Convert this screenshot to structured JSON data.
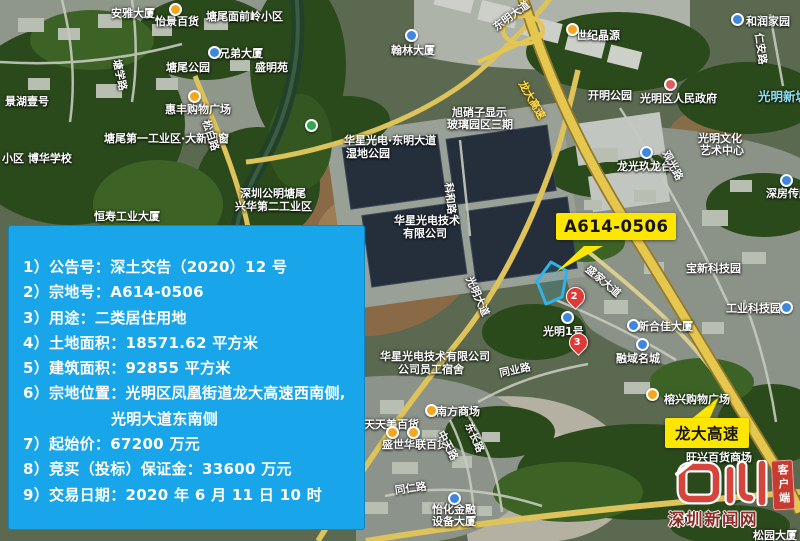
{
  "colors": {
    "panel_blue": "#18a5e9",
    "callout_yellow": "#ffe600",
    "parcel_outline": "#2fb3ea",
    "watermark_red": "#c63c30"
  },
  "info_panel": {
    "lines": [
      "1）公告号：深土交告（2020）12 号",
      "2）宗地号：A614-0506",
      "3）用途：二类居住用地",
      "4）土地面积：18571.62 平方米",
      "5）建筑面积：92855 平方米",
      "6）宗地位置：光明区凤凰街道龙大高速西南侧,",
      "光明大道东南侧",
      "7）起始价：67200 万元",
      "8）竞买（投标）保证金：33600 万元",
      "9）交易日期：2020 年 6 月 11 日 10 时"
    ]
  },
  "callouts": {
    "parcel": {
      "label": "A614-0506"
    },
    "highway": {
      "label": "龙大高速"
    }
  },
  "markers": [
    {
      "label": "2"
    },
    {
      "label": "3"
    }
  ],
  "watermark": {
    "site_name": "深圳新闻网",
    "badge": "客户端"
  },
  "map": {
    "labels": [
      {
        "text": "安雅大厦",
        "x": 111,
        "y": 5
      },
      {
        "text": "怡景百货",
        "x": 155,
        "y": 13
      },
      {
        "text": "塘尾面前岭小区",
        "x": 206,
        "y": 8
      },
      {
        "text": "兄弟大厦",
        "x": 219,
        "y": 45
      },
      {
        "text": "盛明苑",
        "x": 255,
        "y": 59
      },
      {
        "text": "塘尾公园",
        "x": 166,
        "y": 59
      },
      {
        "text": "景湖壹号",
        "x": 5,
        "y": 93
      },
      {
        "text": "惠丰购物广场",
        "x": 165,
        "y": 101
      },
      {
        "text": "翰林大厦",
        "x": 391,
        "y": 42
      },
      {
        "text": "世纪晶源",
        "x": 576,
        "y": 27
      },
      {
        "text": "和润家园",
        "x": 746,
        "y": 13
      },
      {
        "text": "开明公园",
        "x": 588,
        "y": 87
      },
      {
        "text": "光明区人民政府",
        "x": 640,
        "y": 90
      },
      {
        "text": "旭硝子显示",
        "x": 452,
        "y": 104
      },
      {
        "text": "玻璃园区三期",
        "x": 447,
        "y": 116
      },
      {
        "text": "塘尾第一工业区·大新门窗",
        "x": 104,
        "y": 130
      },
      {
        "text": "小区 博华学校",
        "x": 2,
        "y": 150
      },
      {
        "text": "恒寿工业大厦",
        "x": 94,
        "y": 208
      },
      {
        "text": "深圳公明塘尾",
        "x": 240,
        "y": 185
      },
      {
        "text": "兴华第二工业区",
        "x": 235,
        "y": 198
      },
      {
        "text": "华星光电·东明大道",
        "x": 344,
        "y": 132
      },
      {
        "text": "湿地公园",
        "x": 346,
        "y": 145
      },
      {
        "text": "华星光电技术",
        "x": 394,
        "y": 212
      },
      {
        "text": "有限公司",
        "x": 403,
        "y": 225
      },
      {
        "text": "光明文化",
        "x": 698,
        "y": 130
      },
      {
        "text": "艺术中心",
        "x": 700,
        "y": 142
      },
      {
        "text": "龙光玖龙台",
        "x": 617,
        "y": 158
      },
      {
        "text": "深房传麒山",
        "x": 766,
        "y": 185
      },
      {
        "text": "宝新科技园",
        "x": 686,
        "y": 260
      },
      {
        "text": "工业科技园",
        "x": 726,
        "y": 300
      },
      {
        "text": "新合佳大厦",
        "x": 638,
        "y": 318
      },
      {
        "text": "融域名城",
        "x": 616,
        "y": 350
      },
      {
        "text": "光明1号",
        "x": 543,
        "y": 323
      },
      {
        "text": "华星光电技术有限公司",
        "x": 380,
        "y": 348
      },
      {
        "text": "公司员工宿舍",
        "x": 398,
        "y": 361
      },
      {
        "text": "天天美百货",
        "x": 364,
        "y": 416
      },
      {
        "text": "南方商场",
        "x": 436,
        "y": 403
      },
      {
        "text": "盛世华联百货",
        "x": 382,
        "y": 436
      },
      {
        "text": "怡化金融",
        "x": 432,
        "y": 501
      },
      {
        "text": "设备大厦",
        "x": 432,
        "y": 513
      },
      {
        "text": "榕兴购物广场",
        "x": 664,
        "y": 391
      },
      {
        "text": "旺兴百货商场",
        "x": 686,
        "y": 449
      },
      {
        "text": "松园大厦",
        "x": 753,
        "y": 527
      },
      {
        "text": "光明新城",
        "x": 758,
        "y": 86,
        "cls": "mc"
      },
      {
        "text": "东明大道",
        "x": 490,
        "y": 22,
        "rot": -36,
        "cls": "mr"
      },
      {
        "text": "松白路",
        "x": 213,
        "y": 118,
        "rot": 72,
        "cls": "mr"
      },
      {
        "text": "塘学路",
        "x": 124,
        "y": 58,
        "rot": 78,
        "cls": "mr"
      },
      {
        "text": "科和路",
        "x": 456,
        "y": 182,
        "rot": 84,
        "cls": "mr"
      },
      {
        "text": "观光路",
        "x": 672,
        "y": 148,
        "rot": 62,
        "cls": "mr"
      },
      {
        "text": "盛家大道",
        "x": 592,
        "y": 262,
        "rot": 40,
        "cls": "mr"
      },
      {
        "text": "光明大道",
        "x": 476,
        "y": 274,
        "rot": 66,
        "cls": "mr"
      },
      {
        "text": "东长路",
        "x": 475,
        "y": 420,
        "rot": 66,
        "cls": "mr"
      },
      {
        "text": "中天路",
        "x": 447,
        "y": 428,
        "rot": 62,
        "cls": "mr"
      },
      {
        "text": "同业路",
        "x": 498,
        "y": 366,
        "rot": -12,
        "cls": "mr"
      },
      {
        "text": "同仁路",
        "x": 394,
        "y": 483,
        "rot": -8,
        "cls": "mr"
      },
      {
        "text": "仁安路",
        "x": 766,
        "y": 32,
        "rot": 82,
        "cls": "mr"
      },
      {
        "text": "光侨路",
        "x": 668,
        "y": 514,
        "rot": -10,
        "cls": "mr"
      },
      {
        "text": "龙大高速",
        "x": 528,
        "y": 78,
        "rot": 60,
        "cls": "mr mh"
      }
    ],
    "pois": [
      {
        "type": "shop",
        "x": 169,
        "y": 3
      },
      {
        "type": "shop",
        "x": 188,
        "y": 90
      },
      {
        "type": "shop",
        "x": 566,
        "y": 23
      },
      {
        "type": "shop",
        "x": 425,
        "y": 404
      },
      {
        "type": "shop",
        "x": 386,
        "y": 426
      },
      {
        "type": "shop",
        "x": 407,
        "y": 426
      },
      {
        "type": "shop",
        "x": 646,
        "y": 388
      },
      {
        "type": "bldg",
        "x": 405,
        "y": 29
      },
      {
        "type": "bldg",
        "x": 731,
        "y": 13
      },
      {
        "type": "bldg",
        "x": 208,
        "y": 46
      },
      {
        "type": "bldg",
        "x": 640,
        "y": 146
      },
      {
        "type": "bldg",
        "x": 780,
        "y": 174
      },
      {
        "type": "bldg",
        "x": 627,
        "y": 319
      },
      {
        "type": "bldg",
        "x": 636,
        "y": 338
      },
      {
        "type": "bldg",
        "x": 561,
        "y": 311
      },
      {
        "type": "bldg",
        "x": 448,
        "y": 492
      },
      {
        "type": "bldg",
        "x": 780,
        "y": 301
      },
      {
        "type": "park",
        "x": 305,
        "y": 119
      },
      {
        "type": "gov",
        "x": 664,
        "y": 78
      }
    ]
  }
}
